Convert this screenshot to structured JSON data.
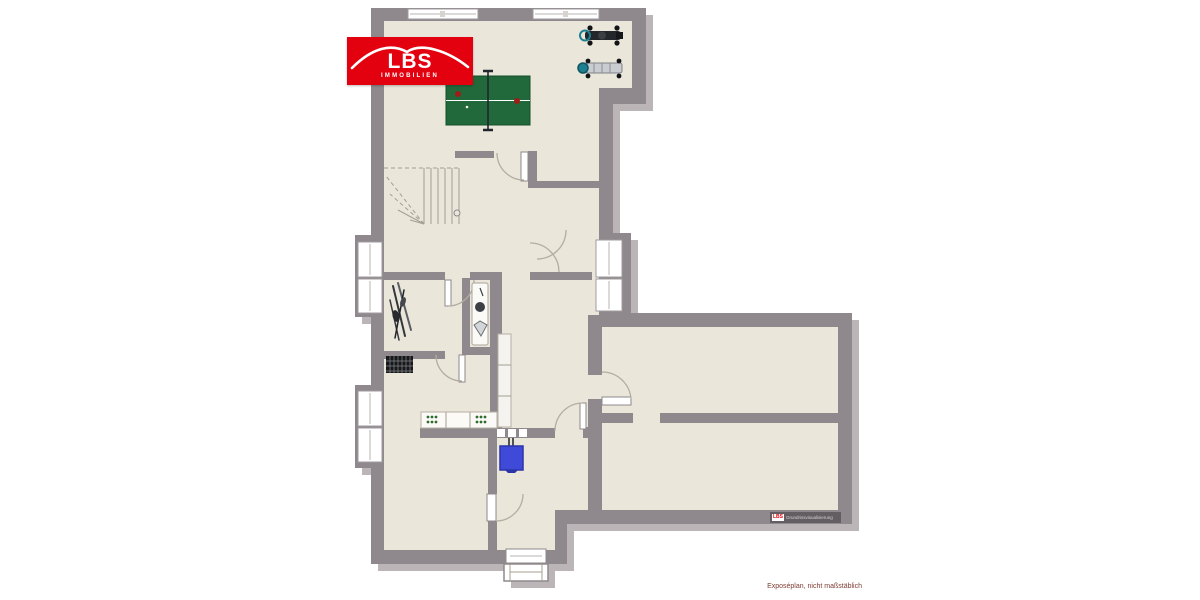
{
  "colors": {
    "page_bg": "#ffffff",
    "wall": "#8f888c",
    "shadow": "#bcb5b8",
    "floor": "#eae6da",
    "accent_red": "#e3000f",
    "table_green": "#21693a",
    "box_blue": "#3f4bd8",
    "machine_teal": "#1d7f8f",
    "caption": "#7d3b33"
  },
  "logo": {
    "brand": "LBS",
    "subtitle": "IMMOBILIEN"
  },
  "watermark": {
    "brand": "LBS",
    "text": "Grundrissvisualisierung"
  },
  "caption": {
    "text": "Exposéplan, nicht maßstäblich"
  },
  "floorplan": {
    "type": "basement-floor-plan",
    "room_labels": [],
    "objects": [
      "table-tennis-table",
      "exercise-machine",
      "exercise-machine",
      "winder-staircase",
      "skis",
      "radiator",
      "wc-fixtures",
      "shelf",
      "laundry-counter",
      "washing-machine",
      "washing-machine",
      "blue-container",
      "entrance-door",
      "entrance-steps"
    ],
    "windows_count": 10,
    "doors_count": 8
  }
}
